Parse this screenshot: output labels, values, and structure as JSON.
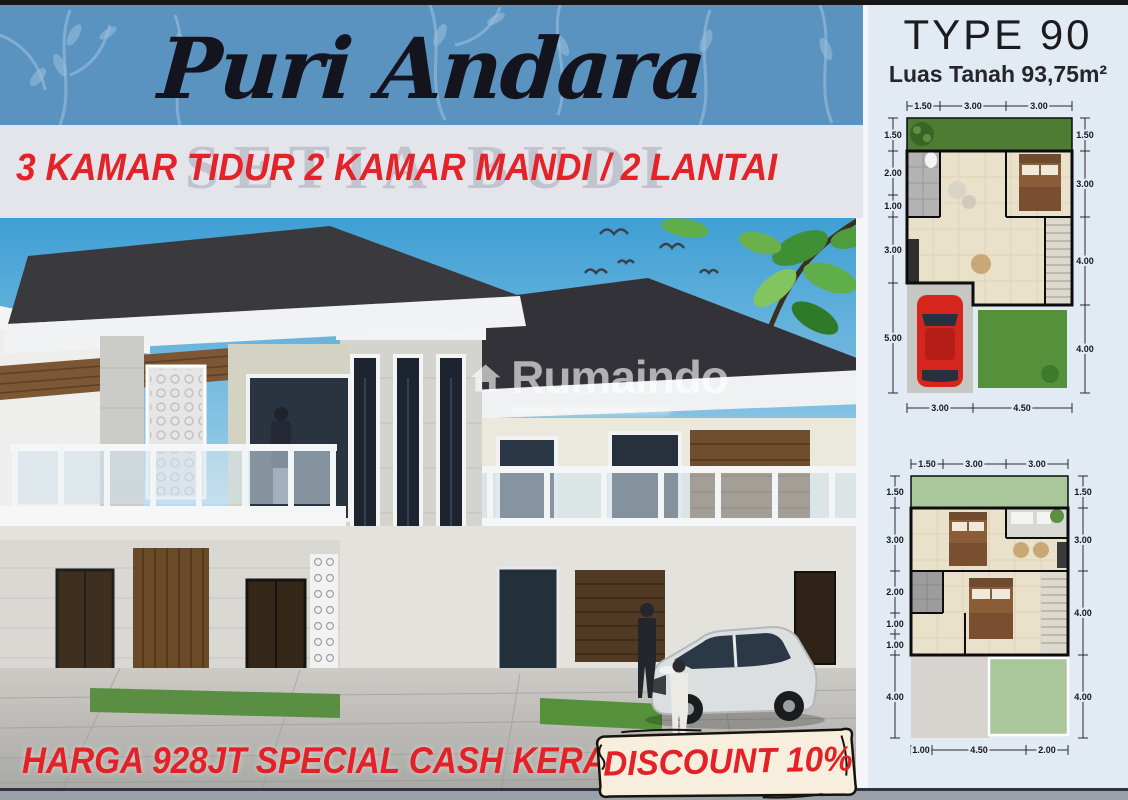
{
  "header": {
    "title": "Puri Andara",
    "subtitle": "3 KAMAR TIDUR 2 KAMAR MANDI / 2 LANTAI",
    "background_watermark": "SETIA BUDI"
  },
  "watermark": {
    "brand": "Rumaindo"
  },
  "footer": {
    "price_text": "HARGA 928JT SPECIAL CASH KERAS",
    "discount_text": "DISCOUNT 10%"
  },
  "plan_panel": {
    "type_title": "TYPE 90",
    "land_area": "Luas Tanah 93,75m²",
    "floor1_dims": {
      "top": [
        "1.50",
        "3.00",
        "3.00"
      ],
      "left": [
        "1.50",
        "2.00",
        "1.00",
        "3.00",
        "5.00"
      ],
      "right": [
        "1.50",
        "3.00",
        "4.00",
        "4.00"
      ],
      "bottom": [
        "3.00",
        "4.50"
      ]
    },
    "floor2_dims": {
      "top": [
        "1.50",
        "3.00",
        "3.00"
      ],
      "left": [
        "1.50",
        "3.00",
        "2.00",
        "1.00",
        "1.00",
        "4.00"
      ],
      "right": [
        "1.50",
        "3.00",
        "4.00",
        "4.00"
      ],
      "bottom": [
        "1.00",
        "4.50",
        "2.00"
      ]
    }
  },
  "colors": {
    "accent_red": "#e42227",
    "band_blue": "#5b93c0",
    "roof_dark": "#38383c",
    "lawn_green": "#55913b"
  }
}
